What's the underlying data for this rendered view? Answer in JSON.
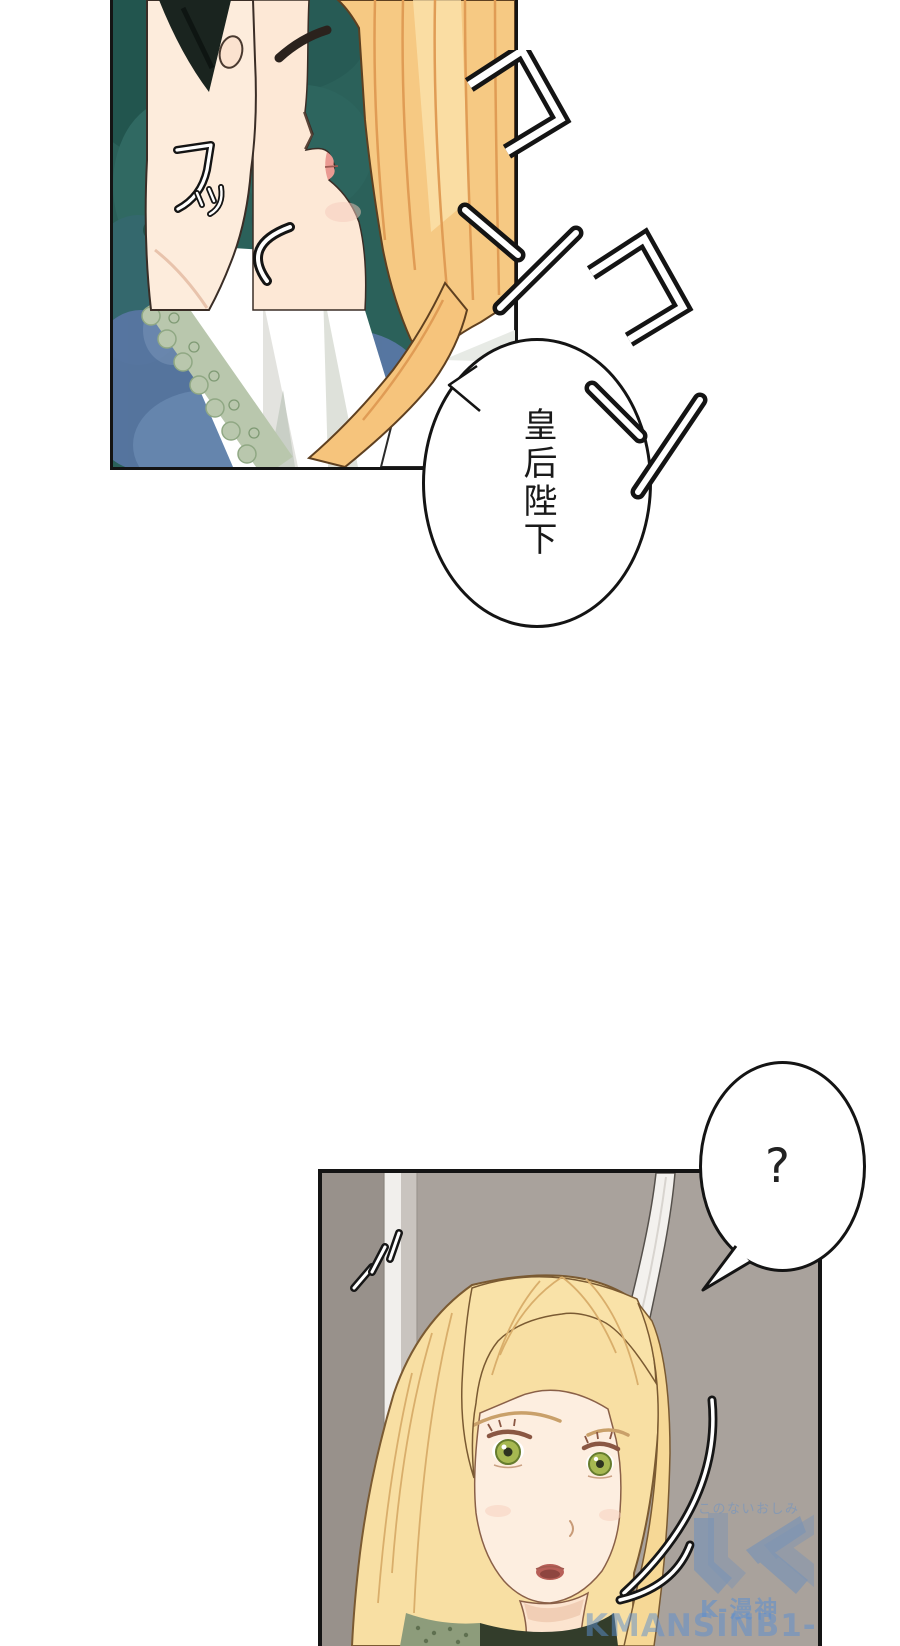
{
  "speech_bubbles": {
    "empress": {
      "text": "皇后陛下",
      "writing": "vertical"
    },
    "question": {
      "text": "?"
    }
  },
  "sound_effects": {
    "knock_1": "コン",
    "knock_2": "コン",
    "chuckle": "フッ"
  },
  "watermark": {
    "tagline": "このないおしみ",
    "site_name": "K-漫神",
    "site_url": "KMANSINB1-99.COM",
    "accent_color": "#5c8fd0"
  },
  "palette": {
    "page_bg": "#ffffff",
    "panel_border": "#141414",
    "panel1_teal": "#2b615a",
    "panel1_blue": "#5f7cab",
    "hair_gold": "#f6c983",
    "hair_pale_gold": "#f8dfa3",
    "skin": "#fdebd9",
    "lace_green": "#b9c7ad",
    "panel2_bg": "#a9a29c",
    "door_strip_white": "#f1efec",
    "eye_green": "#a6b851",
    "lip_pink": "#ea9a92",
    "dress_green": "#37422f"
  }
}
